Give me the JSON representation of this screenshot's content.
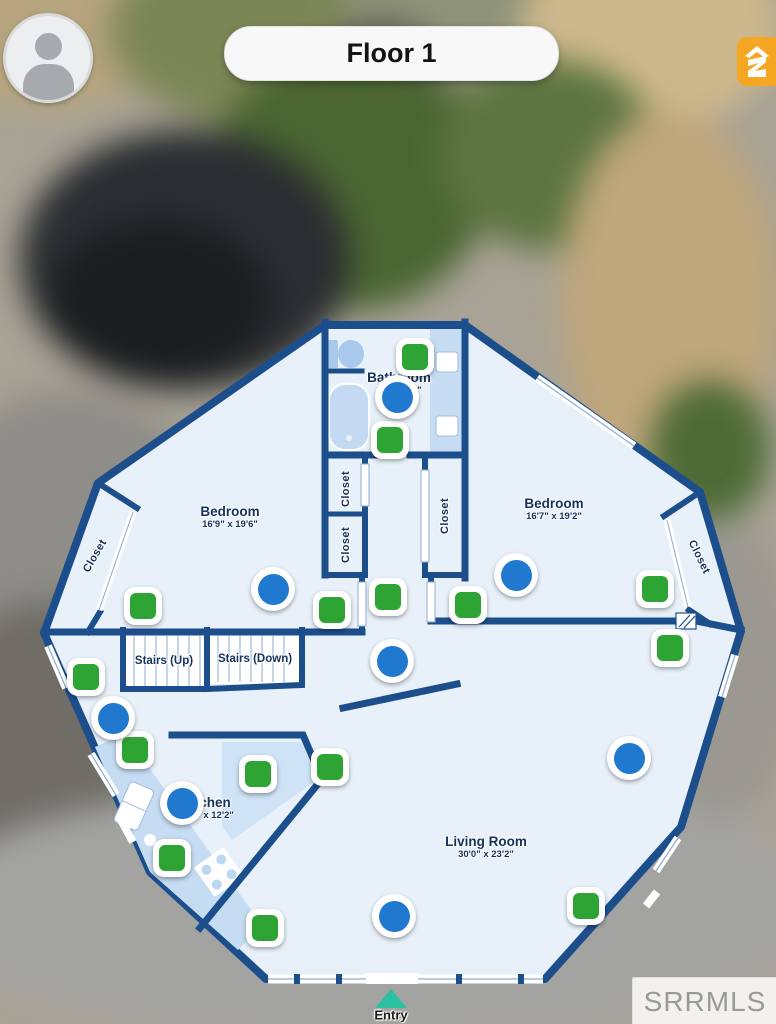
{
  "header": {
    "floor_label": "Floor 1"
  },
  "branding": {
    "logo_icon": "zillow-logo",
    "watermark": "SRRMLS"
  },
  "floorplan": {
    "rooms": {
      "bathroom": {
        "name": "Bathroom",
        "dims": "8'5\" x 9'6\""
      },
      "bedroom_left": {
        "name": "Bedroom",
        "dims": "16'9\" x 19'6\""
      },
      "bedroom_right": {
        "name": "Bedroom",
        "dims": "16'7\" x 19'2\""
      },
      "kitchen": {
        "name": "Kitchen",
        "dims": "13'6\" x 12'2\""
      },
      "living_room": {
        "name": "Living Room",
        "dims": "30'0\" x 23'2\""
      },
      "stairs_up": {
        "name": "Stairs (Up)"
      },
      "stairs_down": {
        "name": "Stairs (Down)"
      },
      "closet_label": "Closet",
      "entry": {
        "name": "Entry"
      }
    },
    "markers": {
      "panorama_green": [
        {
          "x": 415,
          "y": 357
        },
        {
          "x": 390,
          "y": 440
        },
        {
          "x": 143,
          "y": 606
        },
        {
          "x": 332,
          "y": 610
        },
        {
          "x": 388,
          "y": 597
        },
        {
          "x": 468,
          "y": 605
        },
        {
          "x": 655,
          "y": 589
        },
        {
          "x": 670,
          "y": 648
        },
        {
          "x": 86,
          "y": 677
        },
        {
          "x": 135,
          "y": 750
        },
        {
          "x": 258,
          "y": 774
        },
        {
          "x": 330,
          "y": 767
        },
        {
          "x": 172,
          "y": 858
        },
        {
          "x": 265,
          "y": 928
        },
        {
          "x": 586,
          "y": 906
        }
      ],
      "camera_blue": [
        {
          "x": 397,
          "y": 397
        },
        {
          "x": 273,
          "y": 589
        },
        {
          "x": 516,
          "y": 575
        },
        {
          "x": 392,
          "y": 661
        },
        {
          "x": 113,
          "y": 718
        },
        {
          "x": 182,
          "y": 803
        },
        {
          "x": 629,
          "y": 758
        },
        {
          "x": 394,
          "y": 916
        }
      ]
    }
  },
  "colors": {
    "wall": "#1d4e8c",
    "floor": "#e8f1fa",
    "counter": "#c6dcf3",
    "marker_green": "#2ea434",
    "marker_blue": "#2078cf",
    "entry_teal": "#2bc0a2",
    "logo_orange": "#f5a623"
  }
}
